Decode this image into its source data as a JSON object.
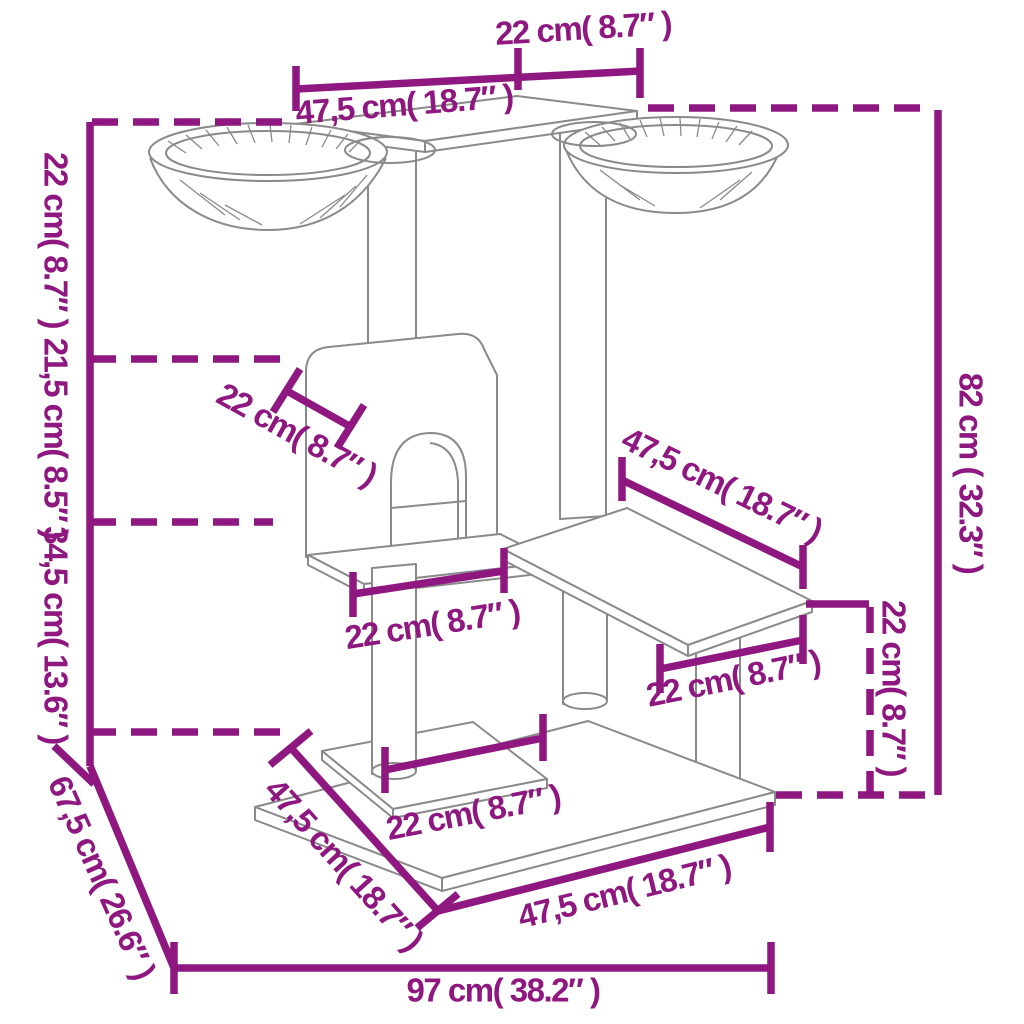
{
  "diagram": {
    "type": "product-dimension-diagram",
    "subject": "cat tree with scratching posts, condo house, platforms and two hanging bowls",
    "accent_color": "#8E1780",
    "sketch_color": "#8A8A8A",
    "background_color": "#FFFFFF"
  },
  "measurements": {
    "top_platform_depth": "22 cm( 8.7″ )",
    "top_platform_width": "47,5 cm( 18.7″ )",
    "height_top_segment": "22 cm( 8.7″ )",
    "height_mid_segment": "21,5 cm( 8.5″ )",
    "height_lower_segment": "34,5 cm( 13.6″ )",
    "house_width": "22 cm( 8.7″ )",
    "house_board_width": "22 cm( 8.7″ )",
    "mid_platform_width": "47,5 cm( 18.7″ )",
    "mid_platform_depth": "22 cm( 8.7″ )",
    "mid_platform_height": "22 cm( 8.7″ )",
    "total_height": "82 cm ( 32.3″ )",
    "base_depth": "67,5 cm( 26.6″ )",
    "base_left_edge": "47,5 cm( 18.7″ )",
    "base_front_edge": "47,5 cm( 18.7″ )",
    "base_width": "97 cm( 38.2″ )",
    "base_board_width": "22 cm( 8.7″ )"
  }
}
